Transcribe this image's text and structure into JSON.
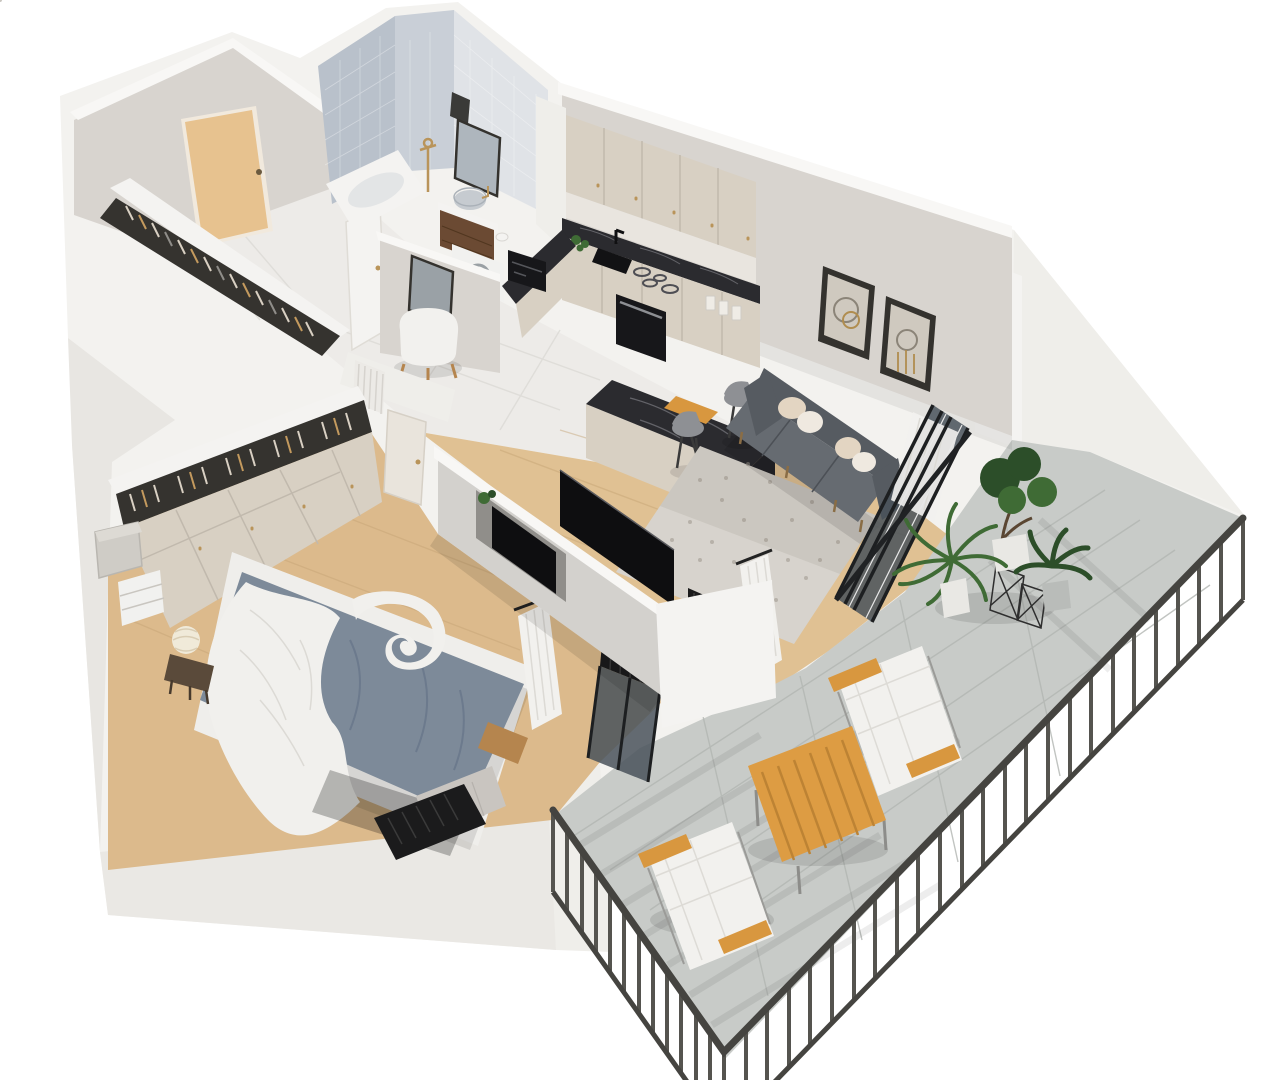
{
  "scene": {
    "kind": "3d-isometric-floorplan-render",
    "description": "Cutaway dollhouse render of a one-bedroom apartment with wrap-around balcony",
    "rooms": [
      {
        "id": "entry-hall",
        "features": [
          "entry-door",
          "open-coat-rack-with-clothes",
          "white-radiator",
          "bathroom-door",
          "wall-mirror",
          "white-pouf"
        ]
      },
      {
        "id": "bathroom",
        "features": [
          "bathtub",
          "brass-shower-fixture",
          "wood-vanity",
          "round-sink",
          "framed-mirror",
          "towel",
          "washing-machine",
          "toilet-paper"
        ]
      },
      {
        "id": "kitchen",
        "features": [
          "upper-cabinets",
          "lower-cabinets",
          "marble-countertop",
          "black-sink",
          "black-faucet",
          "coffee-machine",
          "herb-plants",
          "cooktop",
          "oven",
          "storage-jars",
          "cutting-board",
          "peninsula-bar",
          "bar-stools"
        ]
      },
      {
        "id": "living-room",
        "features": [
          "gray-sofa",
          "throw-pillows",
          "two-wall-art-frames",
          "speckled-rug",
          "tv-on-partition",
          "glazed-balcony-wall",
          "white-curtain",
          "black-radiator"
        ]
      },
      {
        "id": "bedroom",
        "features": [
          "double-bed",
          "blue-duvet",
          "white-blanket",
          "white-area-rug",
          "wardrobe-with-hanging-clothes",
          "wardrobe-doors",
          "storage-boxes",
          "drawer-unit",
          "bedside-lamp",
          "night-stool",
          "tv-niche",
          "plant",
          "curtain",
          "glass-door",
          "black-radiator",
          "knit-throw"
        ]
      },
      {
        "id": "balcony",
        "features": [
          "dark-railing",
          "lounge-chair",
          "lounge-chair",
          "slatted-wood-table",
          "palm-plant",
          "ficus-plant",
          "broadleaf-plant",
          "wire-side-tables",
          "tile-floor"
        ]
      }
    ]
  },
  "colors": {
    "bg": "#ffffff",
    "wallBase": "#f3f2ef",
    "wallTop": "#f8f7f5",
    "wallFace": "#d8d4cf",
    "wallFaceLight": "#e8e6e2",
    "wallFaceDark": "#cbc7c1",
    "wallWhiteFace": "#efeeea",
    "southFace": "#eae8e4",
    "tileBathA": "#b9c1cb",
    "tileBathB": "#c9cfd7",
    "tileBathC": "#e0e3e7",
    "floorTile": "#edebe8",
    "floorTileLine": "#dbd9d5",
    "floorWoodLiving": "#e0c193",
    "floorWoodBed": "#dcba8c",
    "floorWoodLine": "#c3a173",
    "floorBalcony": "#c8cbc8",
    "floorBalconyLine": "#b2b5b2",
    "doorWood": "#e7c28f",
    "doorWhite": "#f4f3f1",
    "clothesDark": "#35332f",
    "hangerLight": "#d9d0c3",
    "hangerTan": "#c49a5e",
    "hangerGray": "#8f8d89",
    "cabinetCream": "#d8d0c3",
    "cabinetSeam": "#c1b9ad",
    "counterMarble": "#2b2b2f",
    "marbleVein": "#898990",
    "applianceBlack": "#17171a",
    "frameDark": "#34322e",
    "frameMat": "#cfc9bf",
    "artBrass": "#b08d4f",
    "artGray": "#8b8478",
    "sofaBack": "#565b61",
    "sofaSeat": "#666b71",
    "pillowWhite": "#efe9e0",
    "pillowTan": "#e3d5c2",
    "rugLiving": "#d7d3cd",
    "rugSpeckle": "#9d978d",
    "rugBed": "#efeeeb",
    "duvetBlue": "#7d8a99",
    "duvetFold": "#68768a",
    "bedWhite": "#f1f0ed",
    "bedWood": "#b5854e",
    "throwGray": "#c9c5c0",
    "radiatorBlack": "#1b1b1c",
    "radiatorWhite": "#eceae6",
    "partitionFace": "#d3d1cd",
    "nicheShade": "#908e8a",
    "tvBlack": "#0e0e10",
    "curtainWhite": "#f2f1ee",
    "curtainFold": "#dcdad5",
    "glassDark": "#49525a",
    "glassFrame": "#1d1f21",
    "railing": "#55544f",
    "railingDark": "#454440",
    "lounger": "#f2f1ee",
    "woodAccent": "#d8973f",
    "woodTable": "#dd9c43",
    "woodTableLine": "#bd8334",
    "plantGreen": "#3f6b35",
    "plantDark": "#2c4e29",
    "potGray": "#b9bcb9",
    "potWhite": "#e9e8e4",
    "brass": "#b9945a",
    "vanityWood": "#6b4a33",
    "sinkGray": "#c6cbd0",
    "machineWhite": "#f1f1ef",
    "stoolGray": "#8e9094",
    "legDark": "#3a3a3a",
    "lampShade": "#f0ead9",
    "nightstand": "#5a4a3a",
    "shadow": "rgba(0,0,0,0.10)",
    "shadowSoft": "rgba(0,0,0,0.06)",
    "shadowStrong": "rgba(0,0,0,0.25)"
  }
}
